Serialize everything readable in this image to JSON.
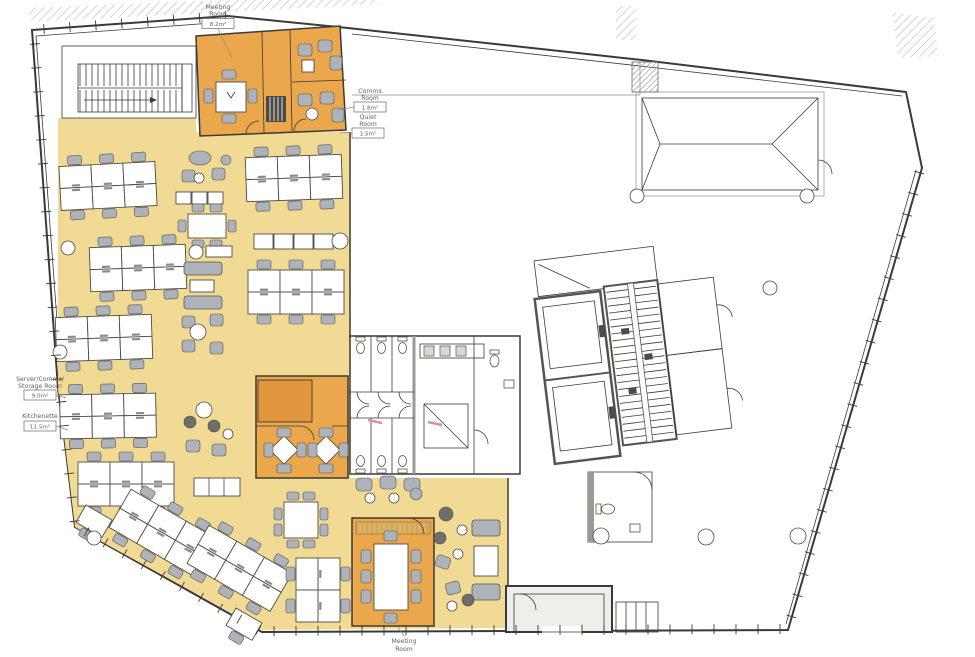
{
  "colors": {
    "paper": "#ffffff",
    "open_plan": "#f1da93",
    "room_orange": "#eba74b",
    "room_orange_dark": "#e0963c",
    "sideboard": "#d9b264",
    "wall": "#3b3a36",
    "wall_light": "#9a9a94",
    "furniture_gray": "#aeb3ba",
    "furniture_dark": "#6e6e6a",
    "accent_pink": "#d491a0",
    "hatch": "#bdbdb6"
  },
  "labels": {
    "meeting_room_top": {
      "lines": [
        "Meeting",
        "Room"
      ],
      "area": "8.2m²"
    },
    "server_storage_room": {
      "lines": [
        "Server/Comms/",
        "Storage Room"
      ],
      "area": "9.0m²"
    },
    "kitchenette": {
      "lines": [
        "Kitchenette"
      ],
      "area": "11.5m²"
    },
    "comms_room": {
      "lines": [
        "Comms",
        "Room"
      ],
      "area": "1.8m²"
    },
    "quiet_room": {
      "lines": [
        "Quiet",
        "Room"
      ],
      "area": "1.5m²"
    },
    "meeting_room_bottom": {
      "lines": [
        "Meeting",
        "Room"
      ]
    }
  }
}
